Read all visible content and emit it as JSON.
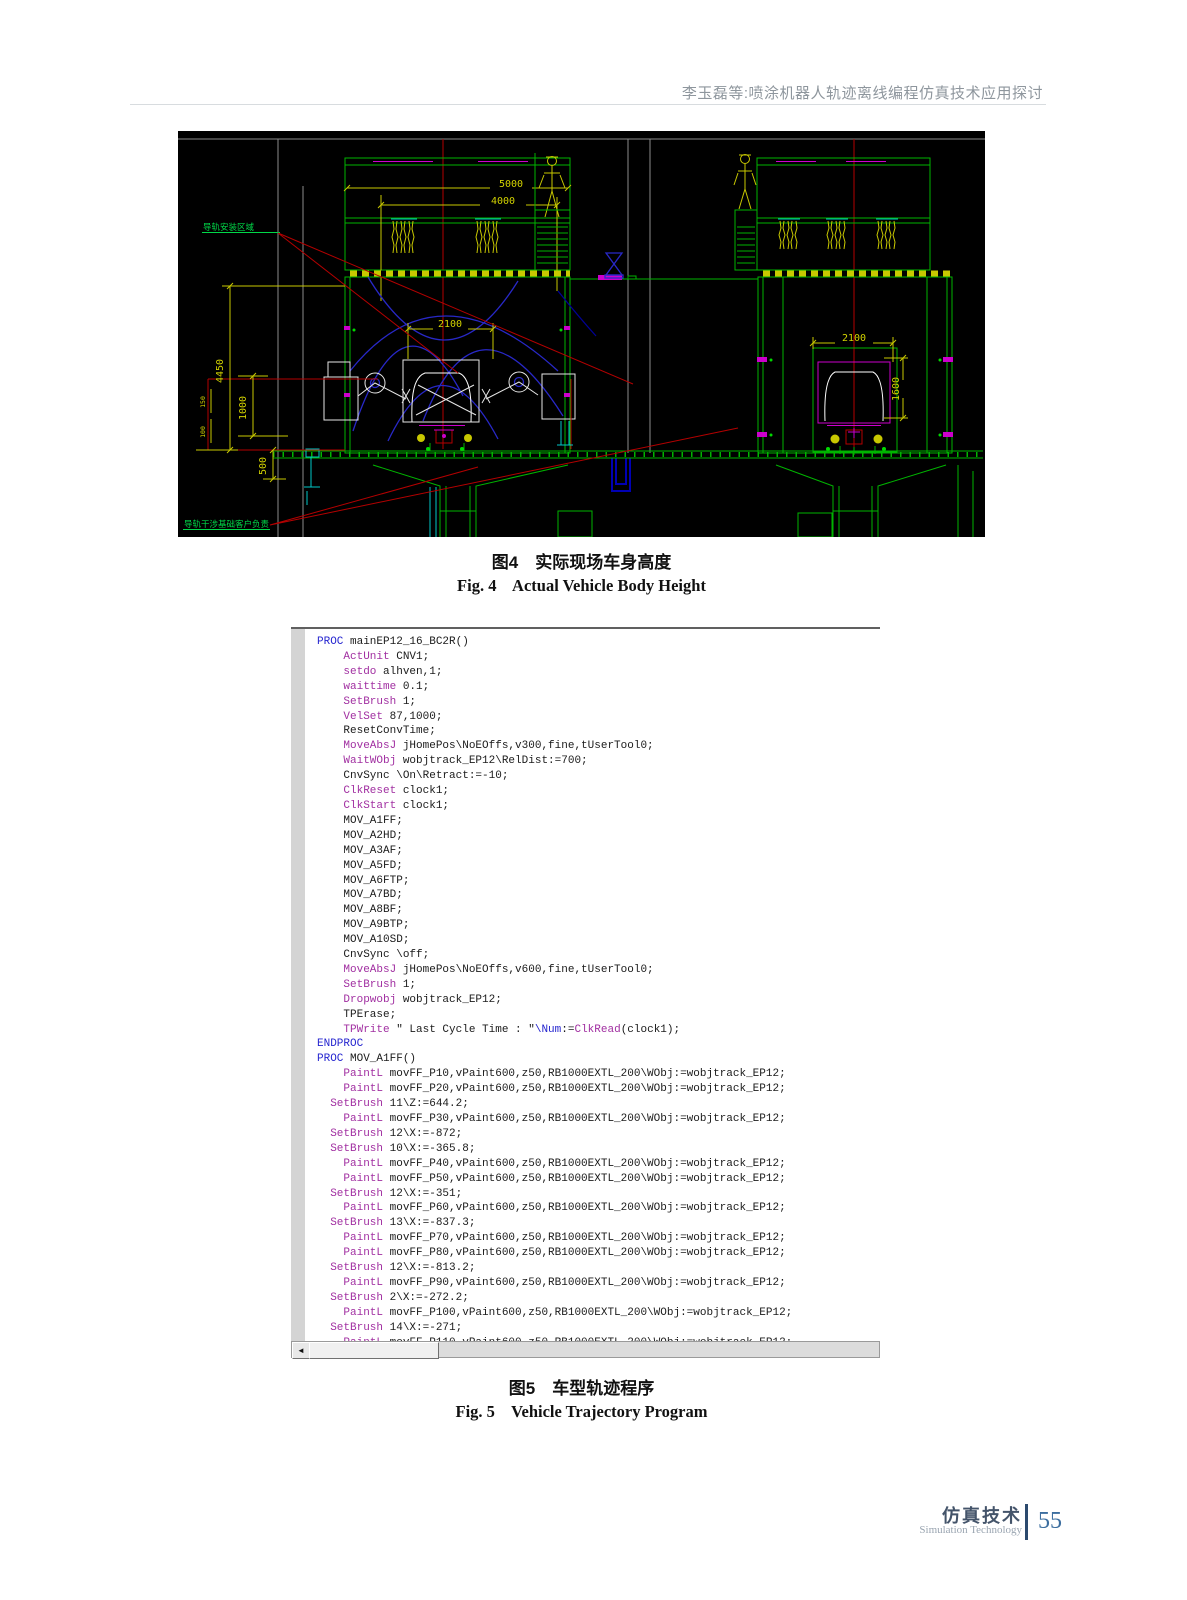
{
  "header": {
    "running_title": "李玉磊等:喷涂机器人轨迹离线编程仿真技术应用探讨"
  },
  "figure4": {
    "caption_zh": "图4　实际现场车身高度",
    "caption_en": "Fig. 4    Actual Vehicle Body Height",
    "cad": {
      "note_top_left": "导轨安装区域",
      "note_bottom_left": "导轨干涉基础客户负责",
      "dims": {
        "d5000": "5000",
        "d4000": "4000",
        "d2100_left": "2100",
        "d2100_right": "2100",
        "d4450": "4450",
        "d1000": "1000",
        "d500": "500",
        "d150": "150",
        "d100": "100",
        "d1600": "1600"
      },
      "palette": {
        "background": "#000000",
        "structure_green": "#00b400",
        "dimension_yellow": "#d2d200",
        "centerline_red": "#b40000",
        "spray_blue": "#2828c8",
        "equipment_white": "#e6e6e6",
        "accent_magenta": "#cc00cc",
        "accent_cyan": "#00c8c8"
      }
    }
  },
  "figure5": {
    "caption_zh": "图5　车型轨迹程序",
    "caption_en": "Fig. 5    Vehicle Trajectory Program",
    "code": {
      "colors": {
        "keyword_blue": "#2525cf",
        "keyword_purple": "#a12fa1",
        "text": "#1b1b1b"
      },
      "lines": [
        [
          [
            "b",
            "PROC"
          ],
          [
            "t",
            " mainEP12_16_BC2R()"
          ]
        ],
        [
          [
            "t",
            "    "
          ],
          [
            "k",
            "ActUnit"
          ],
          [
            "t",
            " CNV1;"
          ]
        ],
        [
          [
            "t",
            "    "
          ],
          [
            "k",
            "setdo"
          ],
          [
            "t",
            " alhven,1;"
          ]
        ],
        [
          [
            "t",
            "    "
          ],
          [
            "k",
            "waittime"
          ],
          [
            "t",
            " 0.1;"
          ]
        ],
        [
          [
            "t",
            "    "
          ],
          [
            "k",
            "SetBrush"
          ],
          [
            "t",
            " 1;"
          ]
        ],
        [
          [
            "t",
            "    "
          ],
          [
            "k",
            "VelSet"
          ],
          [
            "t",
            " 87,1000;"
          ]
        ],
        [
          [
            "t",
            "    ResetConvTime;"
          ]
        ],
        [
          [
            "t",
            "    "
          ],
          [
            "k",
            "MoveAbsJ"
          ],
          [
            "t",
            " jHomePos\\NoEOffs,v300,fine,tUserTool0;"
          ]
        ],
        [
          [
            "t",
            "    "
          ],
          [
            "k",
            "WaitWObj"
          ],
          [
            "t",
            " wobjtrack_EP12\\RelDist:=700;"
          ]
        ],
        [
          [
            "t",
            "    CnvSync \\On\\Retract:=-10;"
          ]
        ],
        [
          [
            "t",
            "    "
          ],
          [
            "k",
            "ClkReset"
          ],
          [
            "t",
            " clock1;"
          ]
        ],
        [
          [
            "t",
            "    "
          ],
          [
            "k",
            "ClkStart"
          ],
          [
            "t",
            " clock1;"
          ]
        ],
        [
          [
            "t",
            "    MOV_A1FF;"
          ]
        ],
        [
          [
            "t",
            "    MOV_A2HD;"
          ]
        ],
        [
          [
            "t",
            "    MOV_A3AF;"
          ]
        ],
        [
          [
            "t",
            "    MOV_A5FD;"
          ]
        ],
        [
          [
            "t",
            "    MOV_A6FTP;"
          ]
        ],
        [
          [
            "t",
            "    MOV_A7BD;"
          ]
        ],
        [
          [
            "t",
            "    MOV_A8BF;"
          ]
        ],
        [
          [
            "t",
            "    MOV_A9BTP;"
          ]
        ],
        [
          [
            "t",
            "    MOV_A10SD;"
          ]
        ],
        [
          [
            "t",
            "    CnvSync \\off;"
          ]
        ],
        [
          [
            "t",
            "    "
          ],
          [
            "k",
            "MoveAbsJ"
          ],
          [
            "t",
            " jHomePos\\NoEOffs,v600,fine,tUserTool0;"
          ]
        ],
        [
          [
            "t",
            "    "
          ],
          [
            "k",
            "SetBrush"
          ],
          [
            "t",
            " 1;"
          ]
        ],
        [
          [
            "t",
            "    "
          ],
          [
            "k",
            "Dropwobj"
          ],
          [
            "t",
            " wobjtrack_EP12;"
          ]
        ],
        [
          [
            "t",
            "    TPErase;"
          ]
        ],
        [
          [
            "t",
            "    "
          ],
          [
            "k",
            "TPWrite"
          ],
          [
            "t",
            " \" Last Cycle Time : \""
          ],
          [
            "b",
            "\\Num"
          ],
          [
            "t",
            ":="
          ],
          [
            "k",
            "ClkRead"
          ],
          [
            "t",
            "(clock1);"
          ]
        ],
        [
          [
            "b",
            "ENDPROC"
          ]
        ],
        [
          [
            "b",
            "PROC"
          ],
          [
            "t",
            " MOV_A1FF()"
          ]
        ],
        [
          [
            "t",
            "    "
          ],
          [
            "k",
            "PaintL"
          ],
          [
            "t",
            " movFF_P10,vPaint600,z50,RB1000EXTL_200\\WObj:=wobjtrack_EP12;"
          ]
        ],
        [
          [
            "t",
            "    "
          ],
          [
            "k",
            "PaintL"
          ],
          [
            "t",
            " movFF_P20,vPaint600,z50,RB1000EXTL_200\\WObj:=wobjtrack_EP12;"
          ]
        ],
        [
          [
            "t",
            "  "
          ],
          [
            "k",
            "SetBrush"
          ],
          [
            "t",
            " 11\\Z:=644.2;"
          ]
        ],
        [
          [
            "t",
            "    "
          ],
          [
            "k",
            "PaintL"
          ],
          [
            "t",
            " movFF_P30,vPaint600,z50,RB1000EXTL_200\\WObj:=wobjtrack_EP12;"
          ]
        ],
        [
          [
            "t",
            "  "
          ],
          [
            "k",
            "SetBrush"
          ],
          [
            "t",
            " 12\\X:=-872;"
          ]
        ],
        [
          [
            "t",
            "  "
          ],
          [
            "k",
            "SetBrush"
          ],
          [
            "t",
            " 10\\X:=-365.8;"
          ]
        ],
        [
          [
            "t",
            "    "
          ],
          [
            "k",
            "PaintL"
          ],
          [
            "t",
            " movFF_P40,vPaint600,z50,RB1000EXTL_200\\WObj:=wobjtrack_EP12;"
          ]
        ],
        [
          [
            "t",
            "    "
          ],
          [
            "k",
            "PaintL"
          ],
          [
            "t",
            " movFF_P50,vPaint600,z50,RB1000EXTL_200\\WObj:=wobjtrack_EP12;"
          ]
        ],
        [
          [
            "t",
            "  "
          ],
          [
            "k",
            "SetBrush"
          ],
          [
            "t",
            " 12\\X:=-351;"
          ]
        ],
        [
          [
            "t",
            "    "
          ],
          [
            "k",
            "PaintL"
          ],
          [
            "t",
            " movFF_P60,vPaint600,z50,RB1000EXTL_200\\WObj:=wobjtrack_EP12;"
          ]
        ],
        [
          [
            "t",
            "  "
          ],
          [
            "k",
            "SetBrush"
          ],
          [
            "t",
            " 13\\X:=-837.3;"
          ]
        ],
        [
          [
            "t",
            "    "
          ],
          [
            "k",
            "PaintL"
          ],
          [
            "t",
            " movFF_P70,vPaint600,z50,RB1000EXTL_200\\WObj:=wobjtrack_EP12;"
          ]
        ],
        [
          [
            "t",
            "    "
          ],
          [
            "k",
            "PaintL"
          ],
          [
            "t",
            " movFF_P80,vPaint600,z50,RB1000EXTL_200\\WObj:=wobjtrack_EP12;"
          ]
        ],
        [
          [
            "t",
            "  "
          ],
          [
            "k",
            "SetBrush"
          ],
          [
            "t",
            " 12\\X:=-813.2;"
          ]
        ],
        [
          [
            "t",
            "    "
          ],
          [
            "k",
            "PaintL"
          ],
          [
            "t",
            " movFF_P90,vPaint600,z50,RB1000EXTL_200\\WObj:=wobjtrack_EP12;"
          ]
        ],
        [
          [
            "t",
            "  "
          ],
          [
            "k",
            "SetBrush"
          ],
          [
            "t",
            " 2\\X:=-272.2;"
          ]
        ],
        [
          [
            "t",
            "    "
          ],
          [
            "k",
            "PaintL"
          ],
          [
            "t",
            " movFF_P100,vPaint600,z50,RB1000EXTL_200\\WObj:=wobjtrack_EP12;"
          ]
        ],
        [
          [
            "t",
            "  "
          ],
          [
            "k",
            "SetBrush"
          ],
          [
            "t",
            " 14\\X:=-271;"
          ]
        ],
        [
          [
            "t",
            "    "
          ],
          [
            "k",
            "PaintL"
          ],
          [
            "t",
            " movFF_P110,vPaint600,z50,RB1000EXTL_200\\WObj:=wobjtrack_EP12;"
          ]
        ]
      ]
    }
  },
  "footer": {
    "journal_zh": "仿真技术",
    "journal_en": "Simulation Technology",
    "page_number": "55"
  }
}
